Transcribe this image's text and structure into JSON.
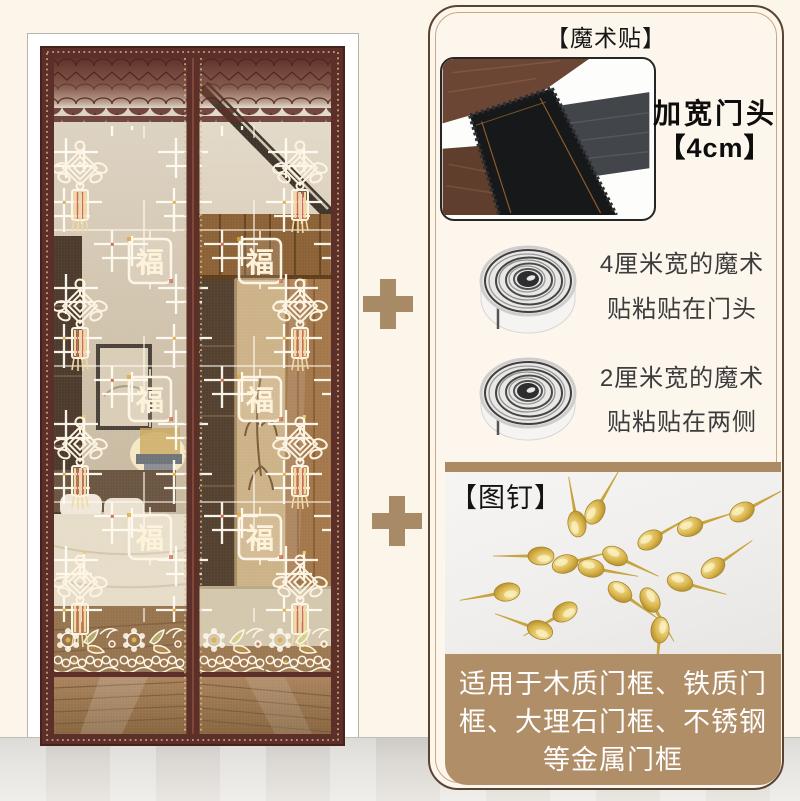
{
  "product": {
    "description": "magnetic lace screen door curtain with accessories",
    "fu_character": "福"
  },
  "right_panel": {
    "velcro": {
      "section_title": "【魔术贴】",
      "door_head_line1": "加宽门头",
      "door_head_line2": "【4cm】",
      "roll_4cm_line1": "4厘米宽的魔术",
      "roll_4cm_line2": "贴粘贴在门头",
      "roll_2cm_line1": "2厘米宽的魔术",
      "roll_2cm_line2": "贴粘贴在两侧"
    },
    "pins": {
      "section_title": "【图钉】",
      "note_line1": "适用于木质门框、铁质门",
      "note_line2": "框、大理石门框、不锈钢",
      "note_line3": "等金属门框"
    }
  },
  "icons": {
    "divider_plus": "plus"
  },
  "colors": {
    "background": "#fcf5e9",
    "panel_border": "#5a4331",
    "panel_inner_line": "#c9a87e",
    "accent_tan": "#ad8a65",
    "door_frame_maroon": "#5c2f28",
    "pushpin_gold": "#d8ae4e",
    "note_block": "#b08e68",
    "note_text": "#ffffff",
    "text_dark": "#1c1c1c"
  }
}
